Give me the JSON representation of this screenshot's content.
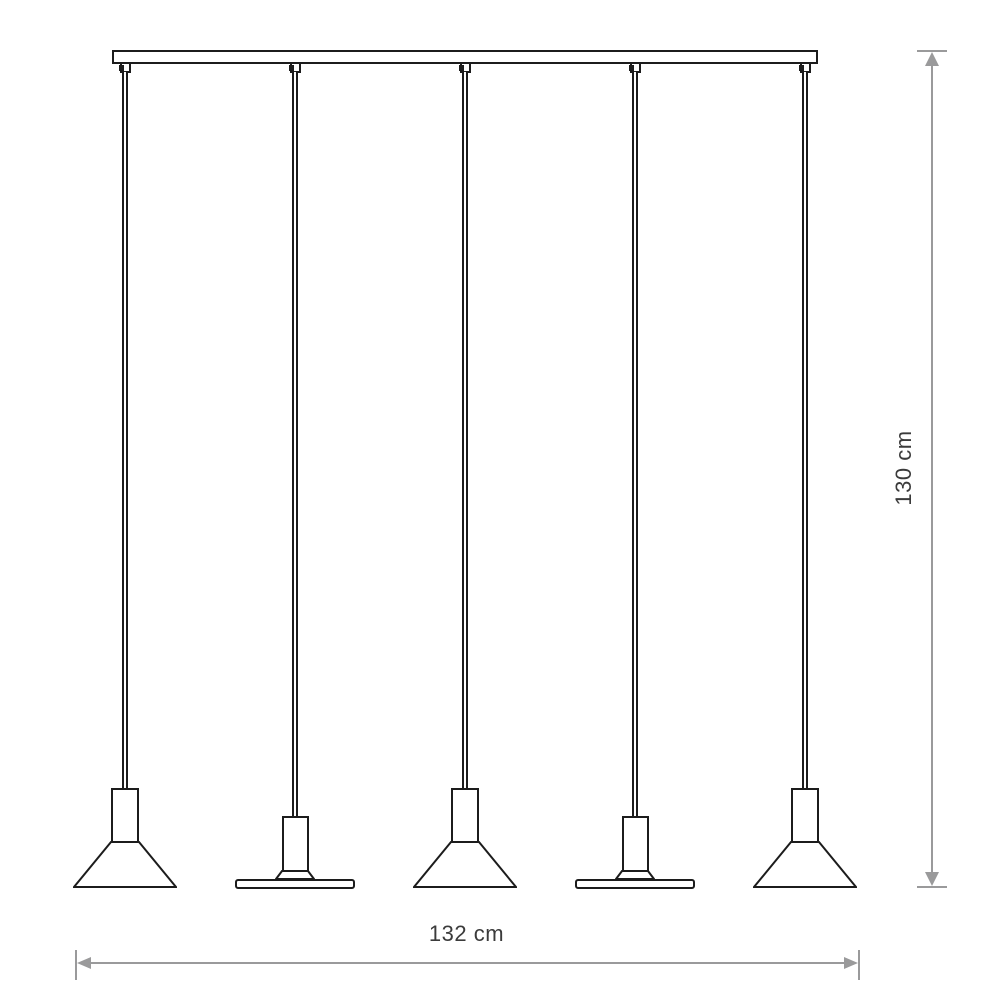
{
  "diagram": {
    "type": "technical-line-drawing",
    "subject": "linear pendant lamp with 5 hanging shades on a ceiling track",
    "dimensions": {
      "width_label": "132 cm",
      "height_label": "130 cm"
    },
    "pendants": [
      {
        "position": 1,
        "shade": "cone"
      },
      {
        "position": 2,
        "shade": "flat-disc"
      },
      {
        "position": 3,
        "shade": "cone"
      },
      {
        "position": 4,
        "shade": "flat-disc"
      },
      {
        "position": 5,
        "shade": "cone"
      }
    ],
    "colors": {
      "outline": "#1c1c1c",
      "dimension_lines": "#9a9a9b",
      "label_text": "#3b3b3b",
      "background": "#ffffff"
    }
  }
}
